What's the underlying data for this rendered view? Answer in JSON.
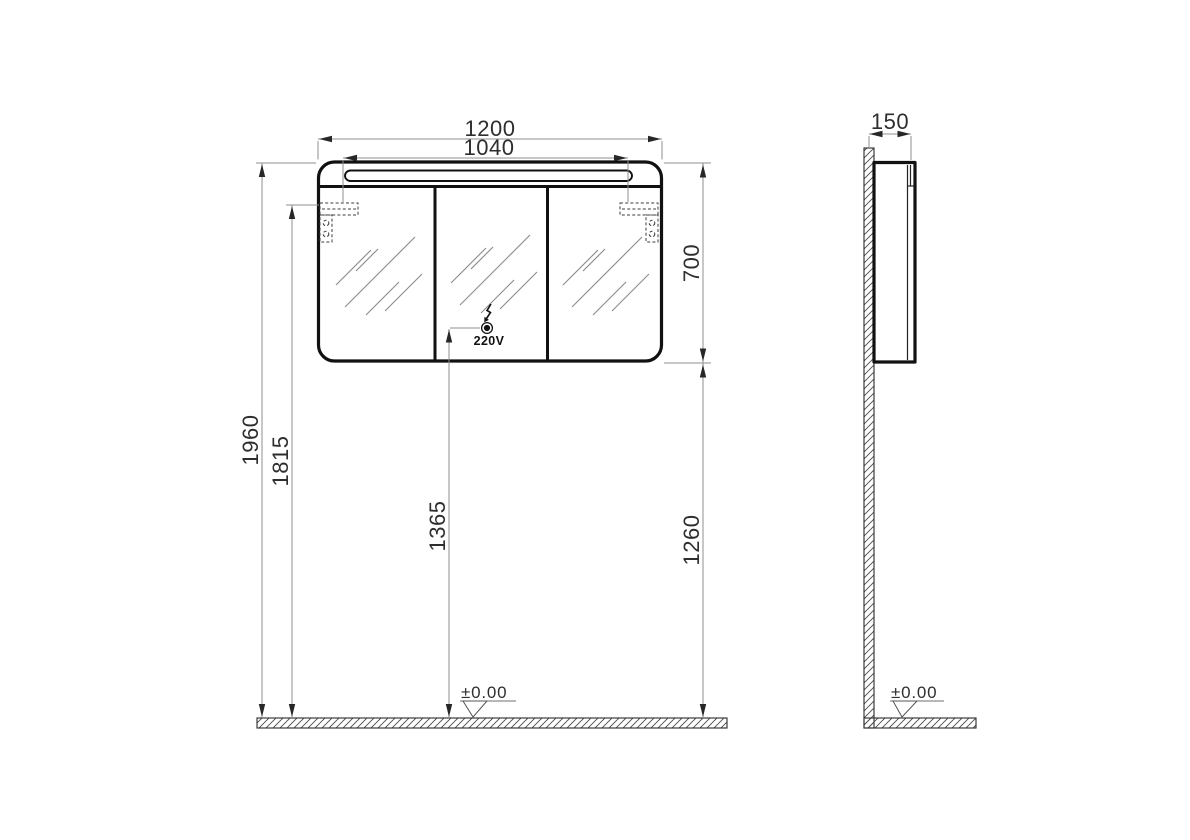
{
  "front_view": {
    "dimensions": {
      "overall_width": "1200",
      "light_width": "1040",
      "cabinet_height": "700",
      "overall_height": "1960",
      "bracket_height": "1815",
      "socket_height": "1365",
      "cabinet_bottom_height": "1260"
    },
    "socket_label": "220V",
    "floor_level": "±0.00"
  },
  "side_view": {
    "dimensions": {
      "depth": "150"
    },
    "floor_level": "±0.00"
  },
  "icons": {
    "power": "lightning-bolt-icon",
    "outlet": "outlet-dot-icon",
    "level": "level-triangle-icon"
  },
  "colors": {
    "outline": "#111111",
    "dimension_line": "#8f8f8f",
    "dimension_text": "#2e2e2e",
    "hatch": "#2a2a2a",
    "background": "#ffffff"
  }
}
